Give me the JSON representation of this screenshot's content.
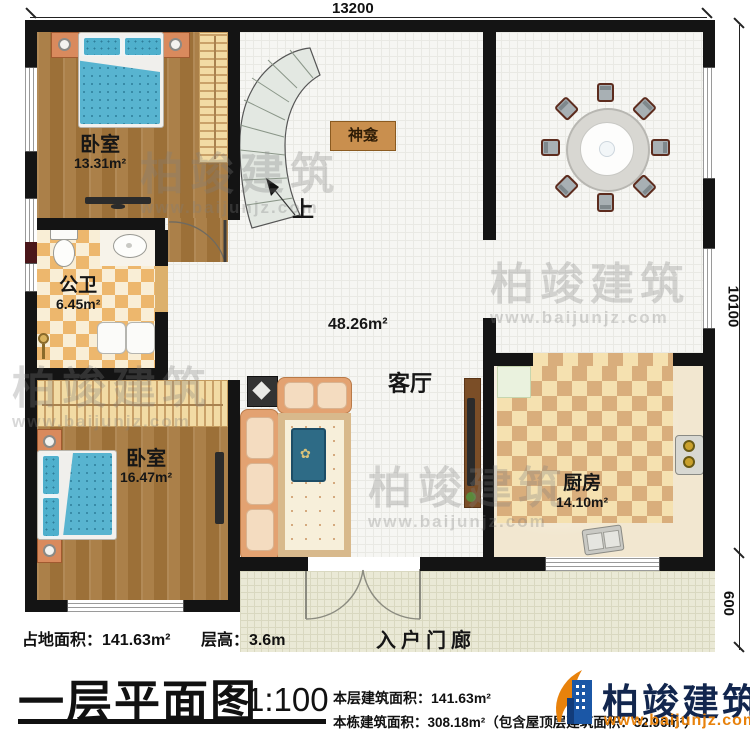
{
  "dimensions": {
    "top": "13200",
    "right_upper": "10100",
    "right_lower": "600"
  },
  "rooms": {
    "bedroom1": {
      "name": "卧室",
      "area": "13.31m²"
    },
    "bedroom2": {
      "name": "卧室",
      "area": "16.47m²"
    },
    "bathroom": {
      "name": "公卫",
      "area": "6.45m²"
    },
    "dining": {
      "name": "餐厅",
      "area": "24.0m²"
    },
    "living": {
      "name": "客厅",
      "area": "48.26m²"
    },
    "kitchen": {
      "name": "厨房",
      "area": "14.10m²"
    },
    "porch": {
      "name": "入户门廊"
    },
    "shrine": {
      "name": "神龛"
    },
    "stairs": {
      "direction": "上"
    }
  },
  "info": {
    "land_area": "占地面积：141.63m²",
    "floor_height": "层高：3.6m",
    "title": "一层平面图",
    "scale": "1:100",
    "floor_area": "本层建筑面积：141.63m²",
    "total_area": "本栋建筑面积：308.18m²（包含屋顶层建筑面积：32.96m²）"
  },
  "brand": {
    "name": "柏竣建筑",
    "url": "www.baijunjz.com"
  },
  "watermark": {
    "name": "柏竣建筑",
    "url": "www.baijunjz.com"
  },
  "colors": {
    "wall": "#141414",
    "wood_floor": "#a6793f",
    "bath_tile_orange": "#edb76d",
    "kitchen_tile_tan": "#d9ae7c",
    "porch_floor": "#eae9d6",
    "bed_blue": "#58b4d0",
    "sofa_orange": "#e3a271",
    "brand_navy": "#12264e",
    "brand_orange": "#e8820c"
  }
}
